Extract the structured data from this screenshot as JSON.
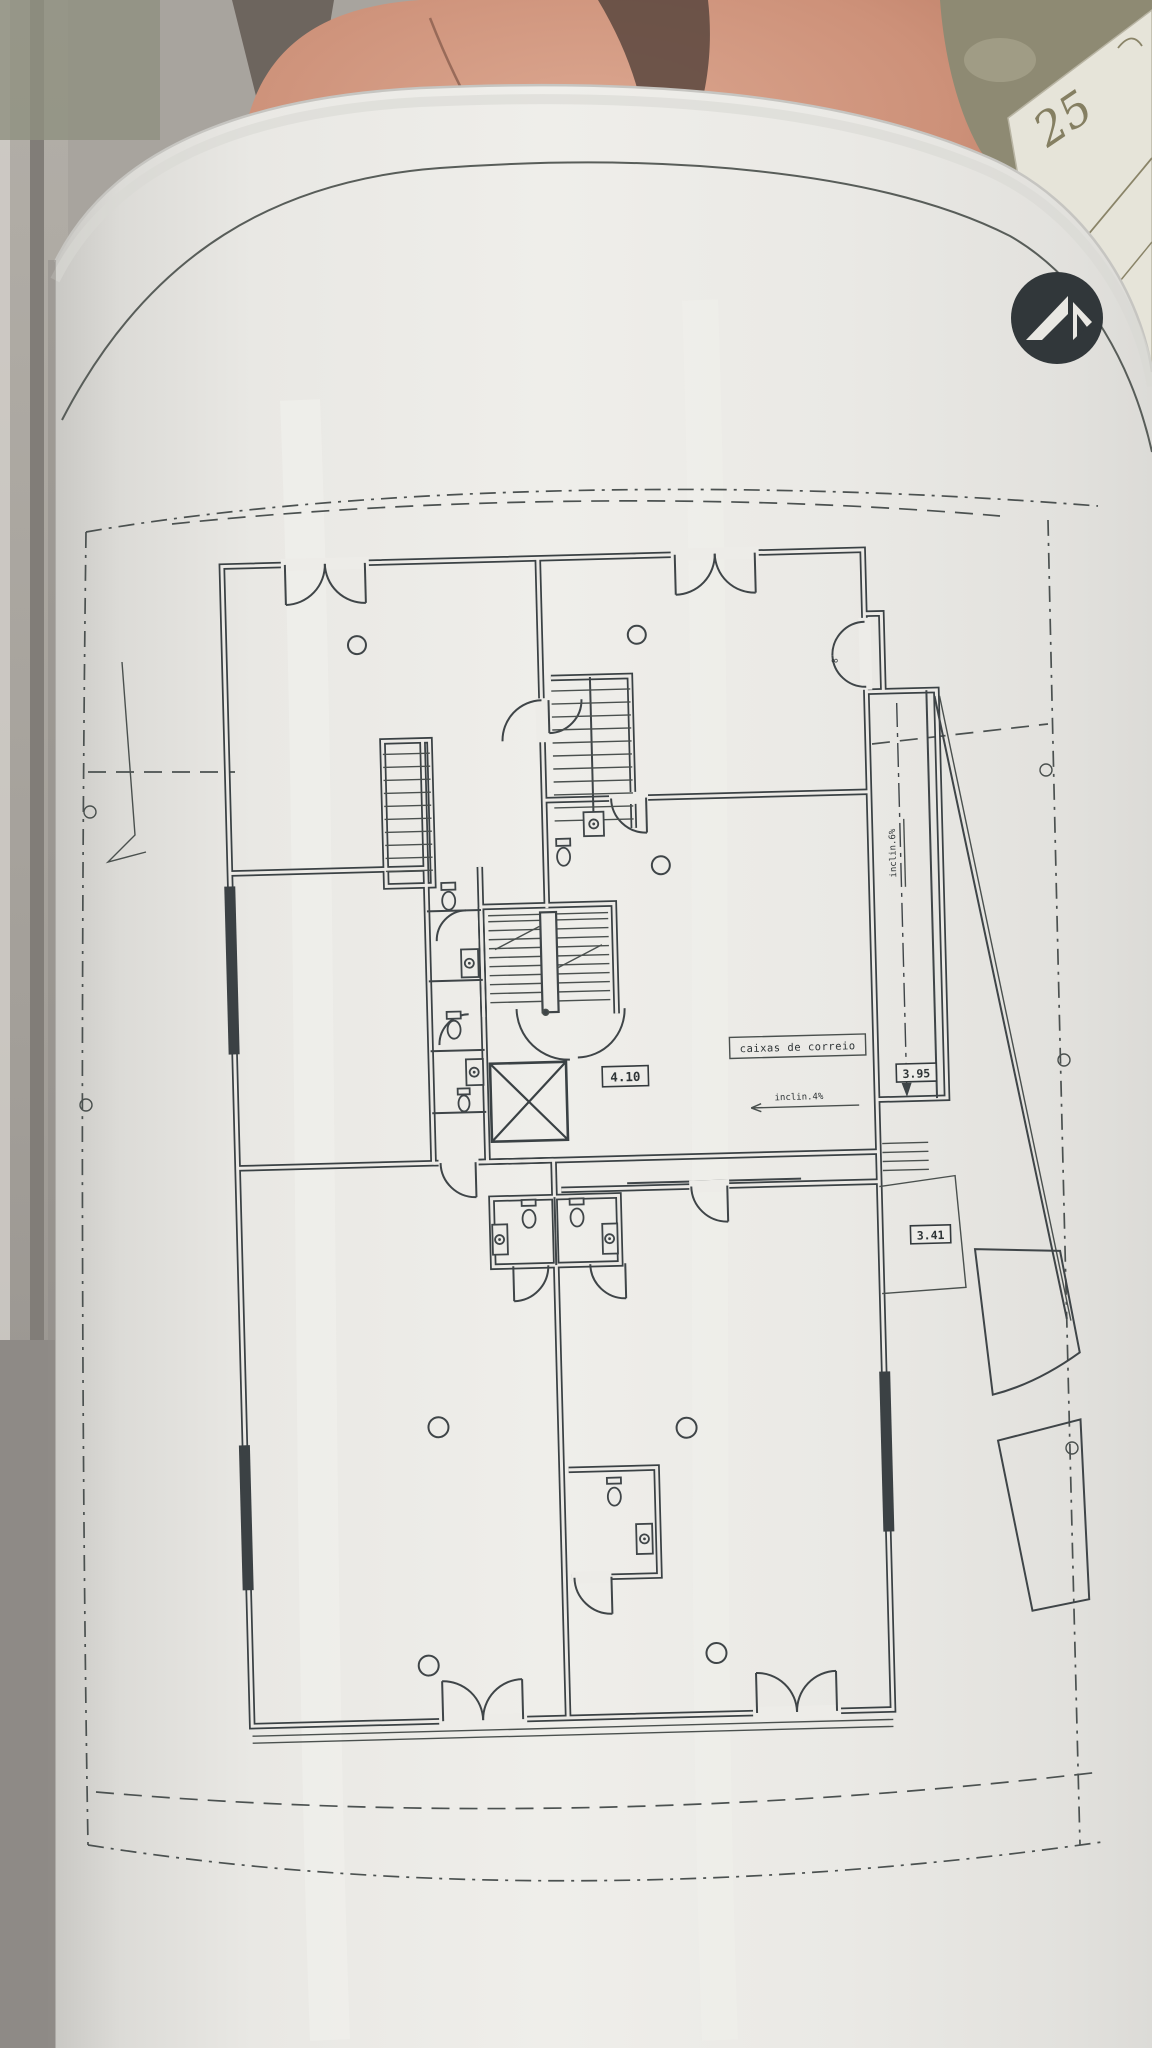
{
  "scene": {
    "description": "Photograph of an architectural ground-floor plan printed on a large curled sheet of paper, with furniture and another drawing sheet visible behind",
    "colors": {
      "paper": "#edece8",
      "ink": "#3a4144",
      "boundary": "#4b5150",
      "leather": "#c98b73",
      "window_frame": "#a39f99",
      "foliage": "#8e8a73",
      "under_sheet": "#e6e4d9",
      "logo": "#31373a"
    }
  },
  "plan": {
    "labels": {
      "mailboxes": "caixas de correio",
      "dim_hall": "4.10",
      "dim_ramp": "3.95",
      "dim_lower": "3.41",
      "slope_entry": "inclin.4%",
      "slope_ramp": "inclin.6%",
      "entrance_mark": "8"
    },
    "symbols": {
      "stairs": "stair-flights",
      "elevator": "elevator-shaft-x",
      "toilet": "toilet-symbol",
      "sink": "sink-symbol",
      "column": "column-symbol"
    }
  },
  "background": {
    "sheet_number": "25"
  },
  "logo": {
    "name": "architect-logo"
  }
}
